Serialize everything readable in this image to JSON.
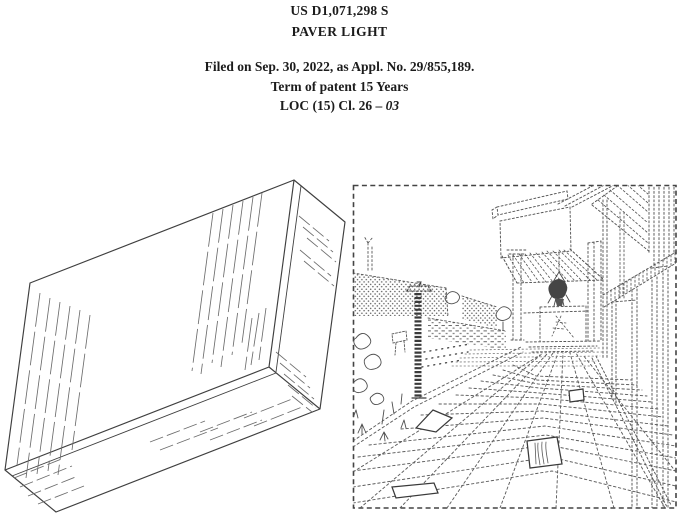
{
  "document": {
    "patent_number": "US D1,071,298 S",
    "title": "PAVER LIGHT",
    "filed_line": "Filed on Sep. 30, 2022, as Appl. No. 29/855,189.",
    "term_line": "Term of patent 15 Years",
    "loc_prefix": "LOC (15) Cl. 26 – ",
    "loc_class": "03"
  },
  "colors": {
    "ink": "#1c1c1c",
    "solid_line": "#3f3f3f",
    "broken_line": "#555555",
    "background": "#ffffff"
  }
}
